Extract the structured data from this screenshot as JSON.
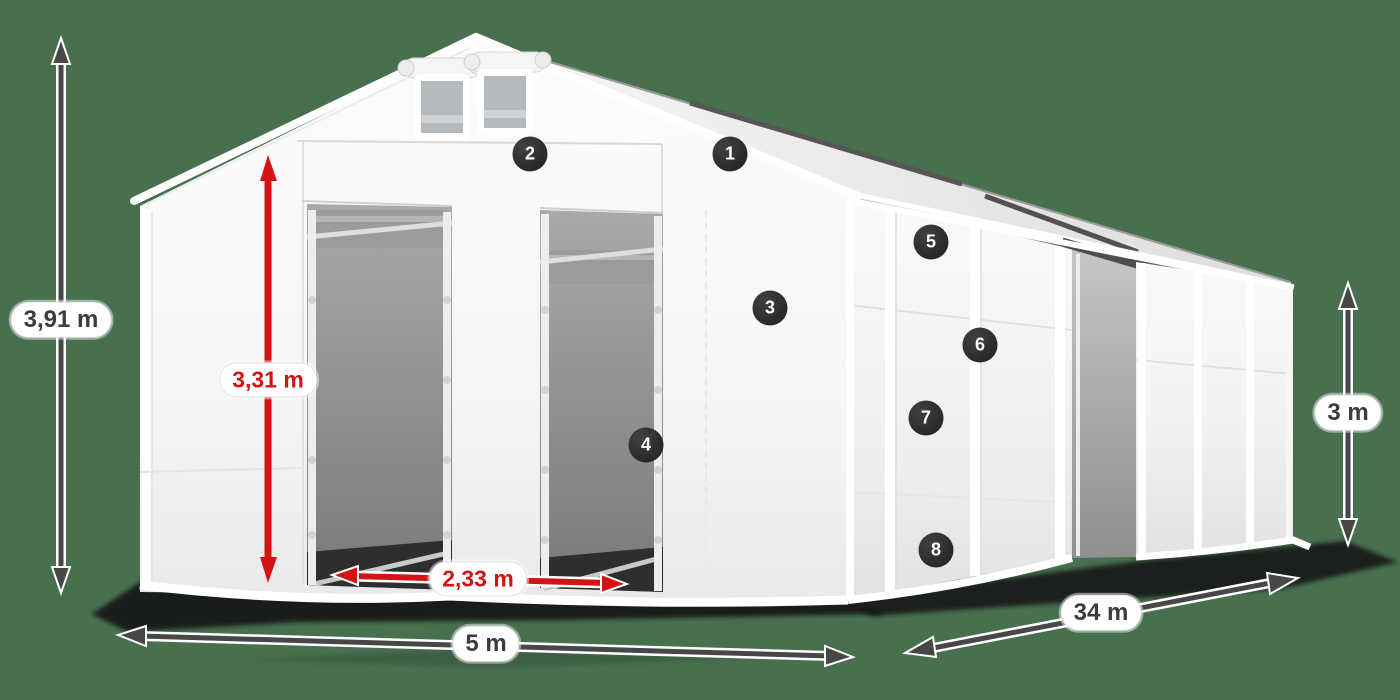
{
  "scene": {
    "background_color": "#48704f",
    "red_accent": "#d41414",
    "dark_dimension_color": "#474747",
    "marker_color": "#2c2c2c"
  },
  "dimensions": {
    "overall_height": "3,91 m",
    "entrance_height": "3,31 m",
    "entrance_width": "2,33 m",
    "tent_width": "5 m",
    "tent_length": "34 m",
    "side_wall_height": "3 m"
  },
  "markers": [
    {
      "label": "1"
    },
    {
      "label": "2"
    },
    {
      "label": "3"
    },
    {
      "label": "4"
    },
    {
      "label": "5"
    },
    {
      "label": "6"
    },
    {
      "label": "7"
    },
    {
      "label": "8"
    }
  ]
}
